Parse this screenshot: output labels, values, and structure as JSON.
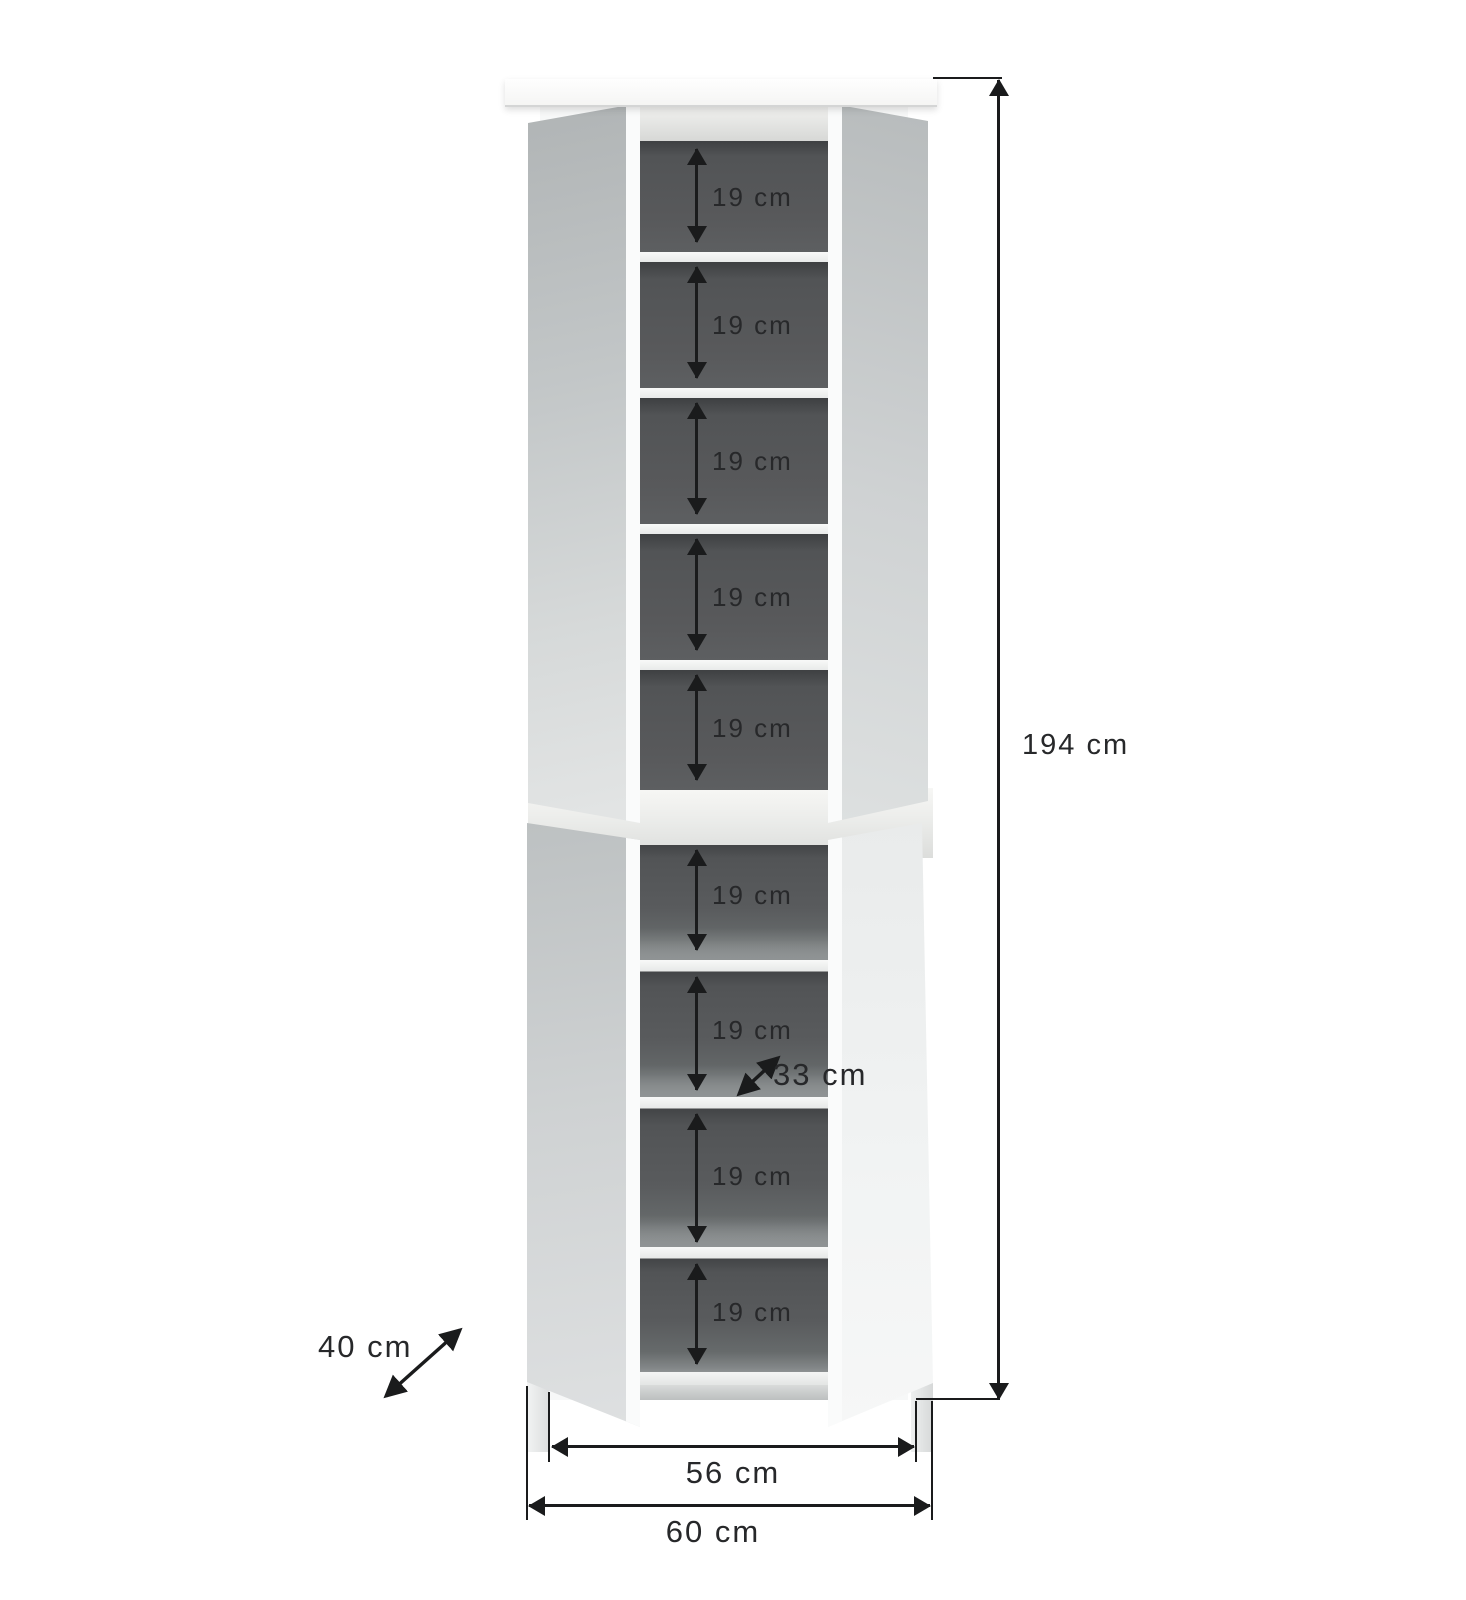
{
  "cabinet": {
    "top_section_shelf_gaps": [
      "19 cm",
      "19 cm",
      "19 cm",
      "19 cm",
      "19 cm"
    ],
    "bottom_section_shelf_gaps": [
      "19 cm",
      "19 cm",
      "19 cm",
      "19 cm"
    ],
    "shelf_depth_label": "33 cm",
    "depth_label": "40 cm",
    "height_label": "194 cm",
    "inner_width_label": "56 cm",
    "outer_width_label": "60 cm"
  },
  "colors": {
    "background": "#ffffff",
    "dimension_lines": "#1a1b1c",
    "label_text": "#27282a",
    "interior": "#58595b",
    "mirror_door": "#c9cdce",
    "carcass": "#f7f8f8"
  }
}
